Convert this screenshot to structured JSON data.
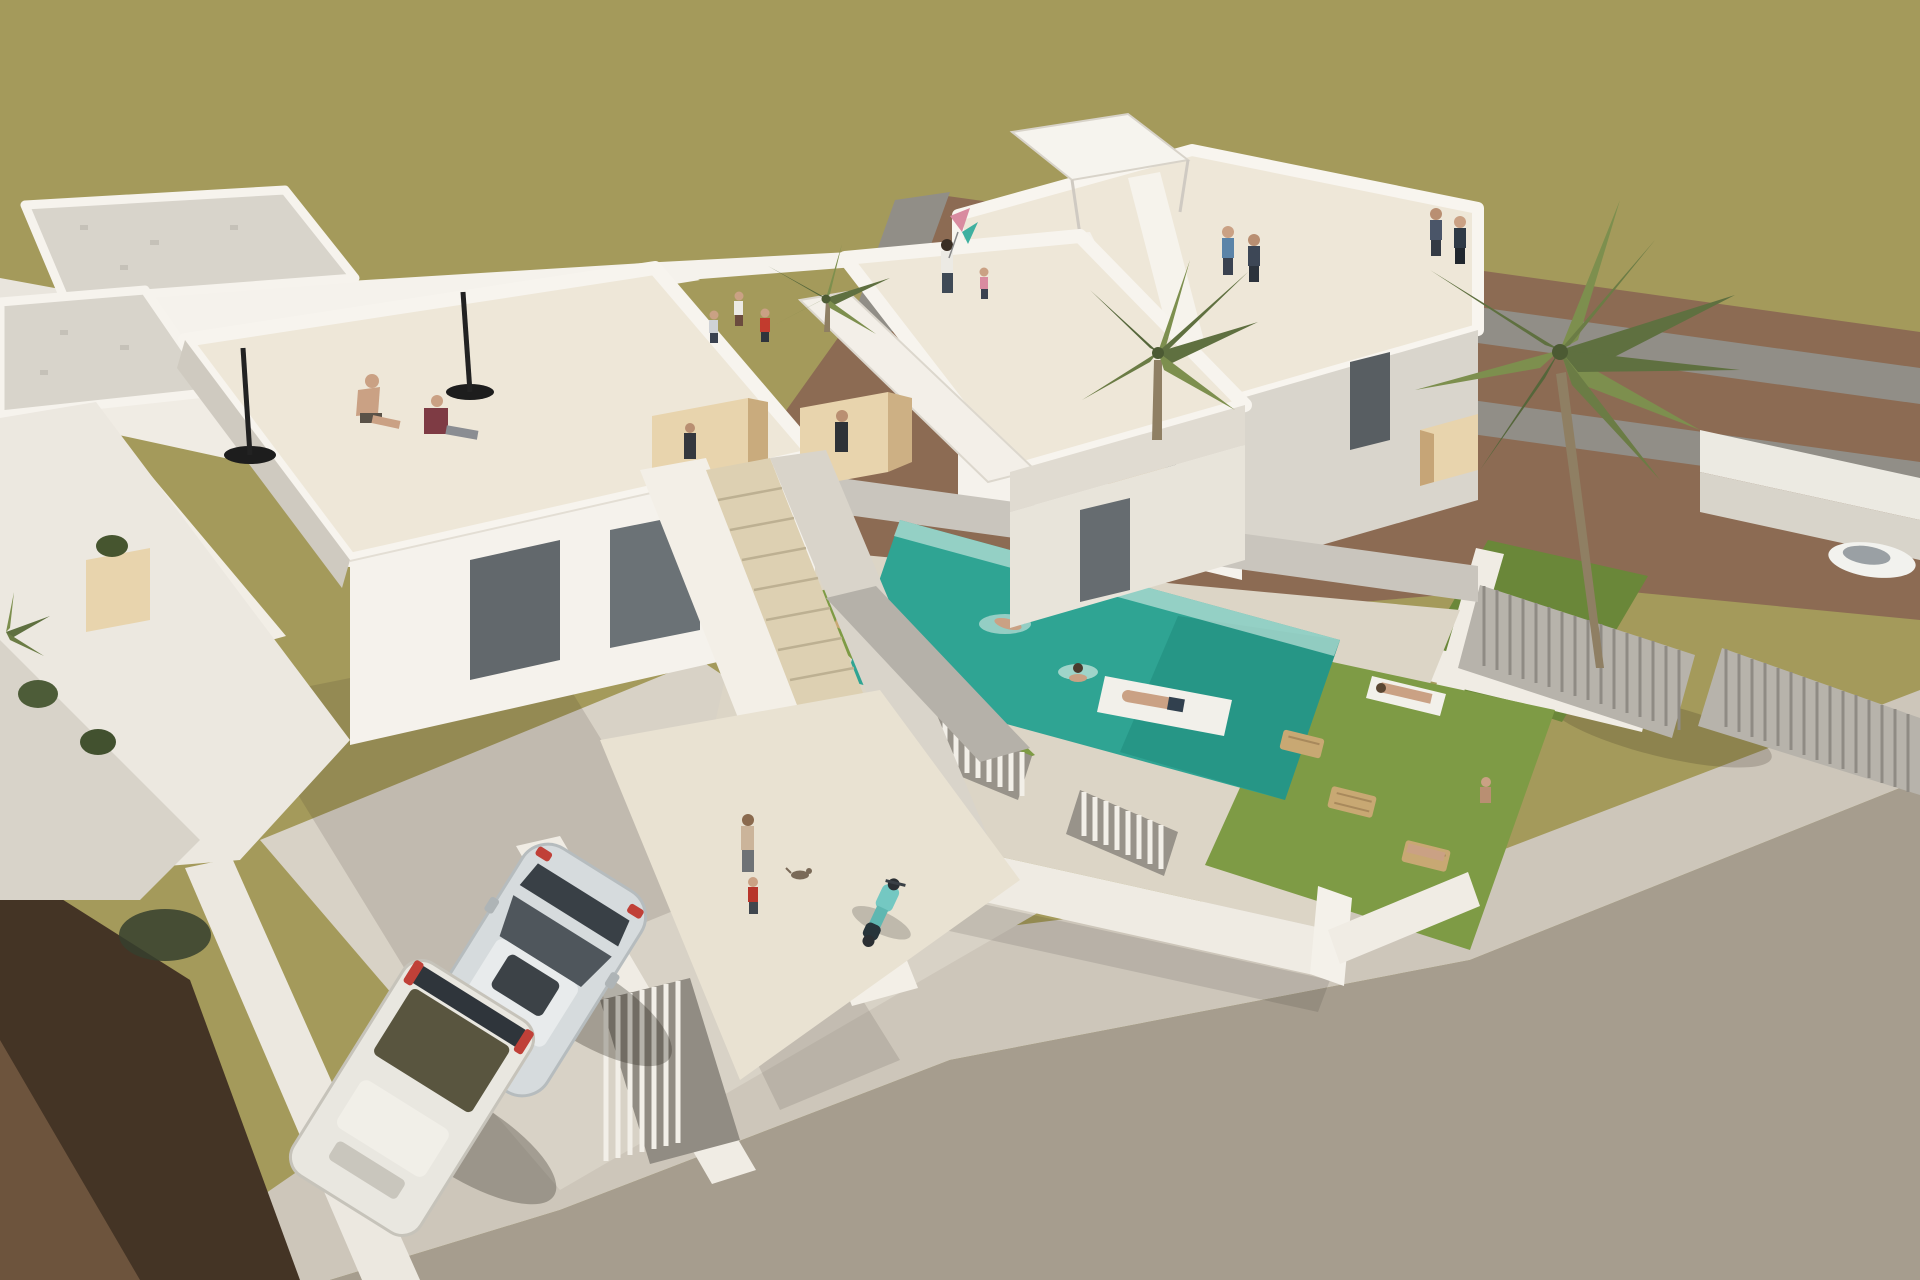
{
  "scene": {
    "description": "Aerial 3D architectural rendering of a new-build residential development: two modern white flat-roof villas with roof terraces and exterior beige staircases, a turquoise swimming pool with swimmers and an air mattress, lawns with wooden sun loungers and sunbathers, palm trees, picket and louvered fences, a parked hatchback and a van on a cobbled driveway beside a street, surrounded by olive-green fields and brown dirt plots.",
    "view": "isometric aerial 3D render",
    "counts": {
      "villas": 2,
      "people": 19,
      "cars": 2,
      "palm_trees": 4,
      "sun_loungers": 5,
      "umbrella_stands": 3,
      "swimmers": 2,
      "pool_floats": 1,
      "scooters": 1
    }
  },
  "palette": {
    "field": "#a49a5b",
    "dirt": "#8c6b53",
    "dirt_road": "#918e87",
    "dark_soil": "#443425",
    "soil_brown": "#6d543d",
    "road": "#a69d8e",
    "sidewalk": "#cdc6ba",
    "driveway": "#d8d2c6",
    "wall_white": "#f5f2ec",
    "wall_light": "#ece8e0",
    "wall_shade": "#d9d5cc",
    "wall_dark": "#b7b3ab",
    "floor_cream": "#eee7d8",
    "glass": "#62686c",
    "wood_light": "#e8d4ad",
    "wood_mid": "#cdb084",
    "gravel": "#d8d4cb",
    "pool_water": "#2fa493",
    "pool_deep": "#1f8a7b",
    "grass": "#7e9b45",
    "grass_shade": "#6a8739",
    "palm_dark": "#5f7040",
    "palm_light": "#7d8f4e",
    "trunk": "#8f7f63",
    "scooter_teal": "#74c8c2",
    "skin": "#caa184",
    "shirt_red": "#c23b2e",
    "shirt_maroon": "#7e3b44",
    "shirt_blue": "#5b84a8",
    "shirt_white": "#eceae4",
    "shirt_pink": "#d98ba0",
    "denim": "#3f4a56",
    "black": "#1d1d1d",
    "taillight": "#c04038",
    "car_silver": "#d6dbdd",
    "car_white": "#e9e7e0",
    "towel_white": "#f2f0ea"
  }
}
